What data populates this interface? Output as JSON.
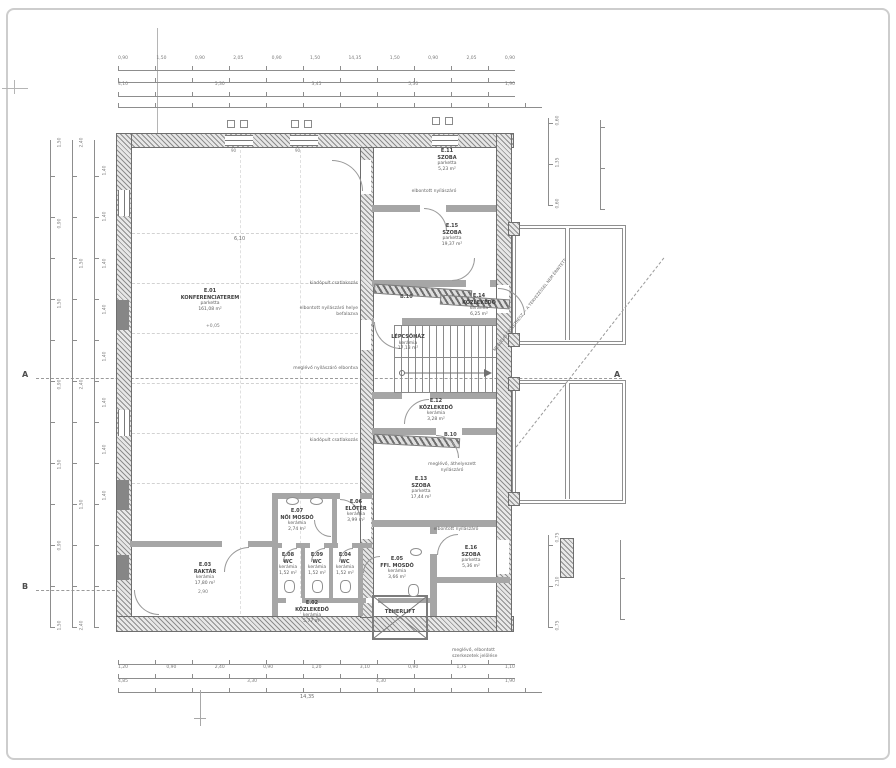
{
  "rooms": [
    {
      "id": "E.01",
      "name": "KONFERENCIATEREM",
      "finish": "parketta",
      "area": "161,08 m²"
    },
    {
      "id": "E.02",
      "name": "KÖZLEKEDŐ",
      "finish": "kerámia",
      "area": "5,77 m²"
    },
    {
      "id": "E.03",
      "name": "RAKTÁR",
      "finish": "kerámia",
      "area": "17,80 m²"
    },
    {
      "id": "E.04",
      "name": "WC",
      "finish": "kerámia",
      "area": "1,52 m²"
    },
    {
      "id": "E.05",
      "name": "FFI. MOSDÓ",
      "finish": "kerámia",
      "area": "3,66 m²"
    },
    {
      "id": "E.06",
      "name": "ELŐTÉR",
      "finish": "kerámia",
      "area": "3,99 m²"
    },
    {
      "id": "E.07",
      "name": "NŐI MOSDÓ",
      "finish": "kerámia",
      "area": "2,74 m²"
    },
    {
      "id": "E.08",
      "name": "WC",
      "finish": "kerámia",
      "area": "1,52 m²"
    },
    {
      "id": "E.09",
      "name": "WC",
      "finish": "kerámia",
      "area": "1,52 m²"
    },
    {
      "id": "E.11",
      "name": "SZOBA",
      "finish": "parketta",
      "area": "5,23 m²"
    },
    {
      "id": "E.12",
      "name": "KÖZLEKEDŐ",
      "finish": "kerámia",
      "area": "3,28 m²"
    },
    {
      "id": "E.13",
      "name": "SZOBA",
      "finish": "parketta",
      "area": "17,44 m²"
    },
    {
      "id": "E.14",
      "name": "KÖZLEKEDŐ",
      "finish": "kerámia",
      "area": "6,25 m²"
    },
    {
      "id": "E.15",
      "name": "SZOBA",
      "finish": "parketta",
      "area": "19,37 m²"
    },
    {
      "id": "E.16",
      "name": "SZOBA",
      "finish": "parketta",
      "area": "5,36 m²"
    },
    {
      "id": "",
      "name": "LÉPCSŐHÁZ",
      "finish": "kerámia",
      "area": "17,13 m²"
    },
    {
      "id": "",
      "name": "TEHERLIFT",
      "finish": "",
      "area": ""
    }
  ],
  "dims": {
    "top": [
      "0,90",
      "1,50",
      "0,90",
      "2,05",
      "0,90",
      "1,50",
      "14,35",
      "1,50",
      "0,90",
      "2,05",
      "0,90"
    ],
    "top2": [
      "4,10",
      "5,30",
      "3,45",
      "5,30",
      "1,90"
    ],
    "bottom": [
      "1,20",
      "0,90",
      "2,40",
      "0,90",
      "1,20",
      "3,10",
      "0,90",
      "1,75",
      "1,10"
    ],
    "bottom2": [
      "4,85",
      "3,30",
      "4,30",
      "1,90"
    ],
    "left": [
      "1,50",
      "0,90",
      "1,50",
      "0,90",
      "1,50",
      "0,90",
      "1,50"
    ],
    "left2": [
      "2,40",
      "1,50",
      "2,40",
      "1,50",
      "2,40"
    ],
    "right_top": [
      "0,60",
      "1,35",
      "0,60"
    ],
    "right_bottom": [
      "0,75",
      "2,10",
      "0,75"
    ],
    "levels": [
      "1,40",
      "1,40",
      "1,40",
      "1,40",
      "1,40",
      "1,40",
      "1,40",
      "1,40"
    ],
    "misc": {
      "room_width": "6,10",
      "sill_a": "90",
      "sill_b": "90",
      "raktar_h": "2,90",
      "level": "+0,05",
      "total_bottom": "14,35"
    }
  },
  "markers": {
    "section_a": "A",
    "section_b": "B",
    "b10": "B.10"
  },
  "annotations": {
    "counter_top": "kiadópult csatlakozás",
    "infill": "elbontott nyílászáró helye befalazva",
    "removed_window": "meglévő nyílászáró elbontva",
    "counter_bottom": "kiadópult csatlakozás",
    "removed_top": "elbontott nyílászáró",
    "relocated": "meglévő, áthelyezett nyílászáró",
    "removed_mid": "elbontott nyílászáró",
    "diagonal": "MEGLÉVŐ ÉPÜLETRÉSZ — A TERVEZÉSSEL NEM ÉRINTETT",
    "bottom_note_line1": "meglévő, elbontott",
    "bottom_note_line2": "szerkezetek jelölése"
  }
}
